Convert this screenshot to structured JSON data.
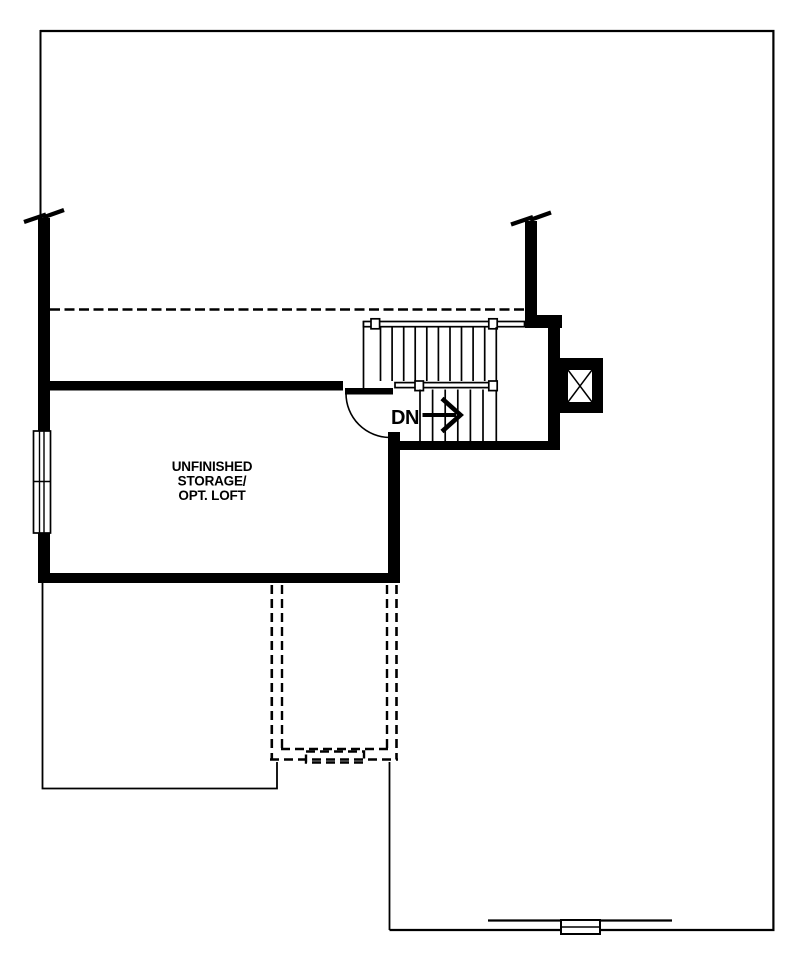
{
  "colors": {
    "ink": "#000000",
    "paper": "#ffffff"
  },
  "room": {
    "name_line1": "UNFINISHED",
    "name_line2": "STORAGE/",
    "name_line3": "OPT. LOFT"
  },
  "stair": {
    "direction_label": "DN"
  }
}
